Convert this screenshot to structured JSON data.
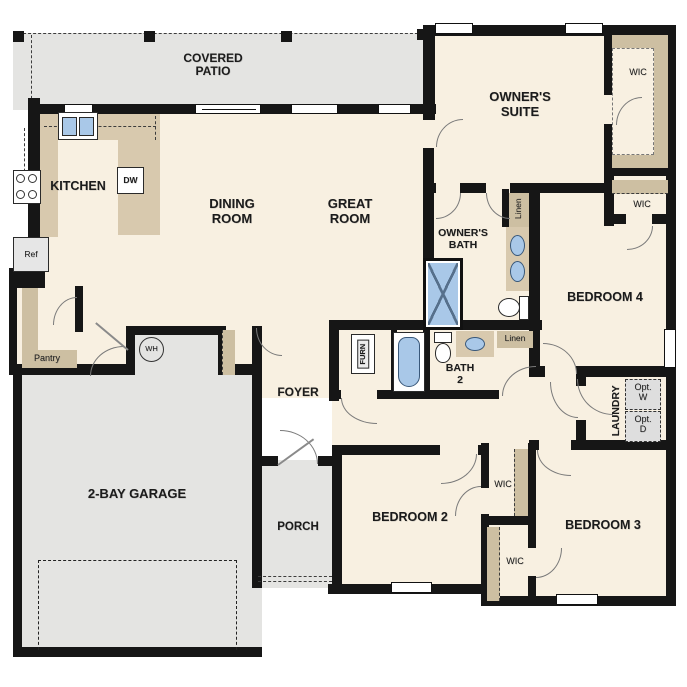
{
  "rooms": {
    "covered_patio": "COVERED PATIO",
    "kitchen": "KITCHEN",
    "dining_room": "DINING ROOM",
    "great_room": "GREAT ROOM",
    "owners_suite": "OWNER'S SUITE",
    "owners_bath": "OWNER'S BATH",
    "bath_2": "BATH 2",
    "bedroom_2": "BEDROOM 2",
    "bedroom_3": "BEDROOM 3",
    "bedroom_4": "BEDROOM 4",
    "foyer": "FOYER",
    "porch": "PORCH",
    "garage": "2-BAY GARAGE",
    "laundry": "LAUNDRY"
  },
  "closets": {
    "wic": "WIC",
    "pantry": "Pantry",
    "linen": "Linen"
  },
  "appliances": {
    "dishwasher": "DW",
    "refrigerator": "Ref",
    "water_heater": "WH",
    "furnace": "FURN",
    "optional_washer": [
      "Opt.",
      "W"
    ],
    "optional_dryer": [
      "Opt.",
      "D"
    ]
  },
  "colors": {
    "floor": "#f8f0e1",
    "outdoor": "#e4e4e2",
    "cabinet": "#d8c9ae",
    "shelf": "#cdbfa2",
    "wall": "#161616",
    "fixture_blue": "#a9c8e8"
  }
}
